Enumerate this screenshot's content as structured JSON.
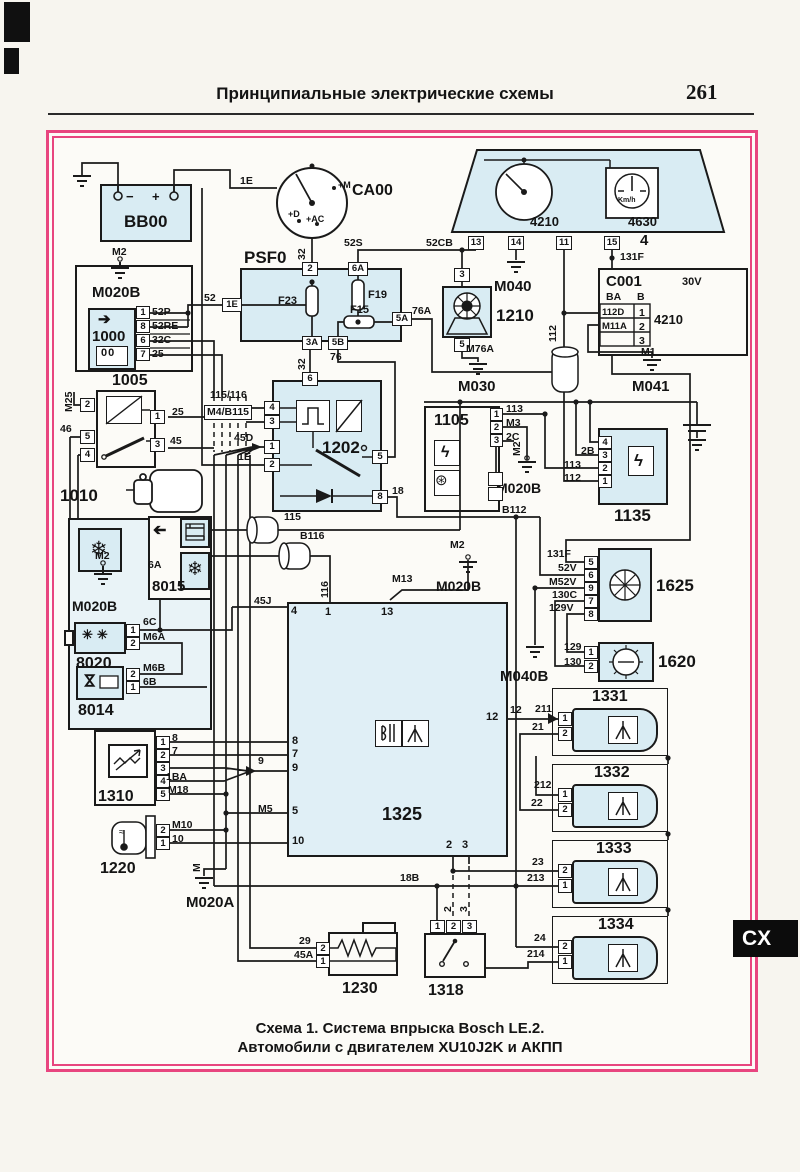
{
  "page": {
    "header": "Принципиальные электрические схемы",
    "page_number": "261",
    "tab": "CX",
    "caption1": "Схема 1. Система впрыска Bosch LE.2.",
    "caption2": "Автомобили с двигателем XU10J2K и АКПП",
    "accent": "#e8457f",
    "fill": "#d9ecf3"
  },
  "components": {
    "bb00": {
      "label": "BB00",
      "minus": "−",
      "plus": "+"
    },
    "ca00": {
      "label": "CA00",
      "tm": "+M",
      "td": "+D",
      "tac": "+AC"
    },
    "psf0": {
      "label": "PSF0",
      "f23": "F23",
      "f19": "F19",
      "f15": "F15",
      "pins": [
        "2",
        "6A",
        "1E",
        "3A",
        "5B",
        "5A"
      ]
    },
    "cluster": {
      "tacho": "4210",
      "speedo": "4630",
      "unit": "Km/h",
      "num": "4",
      "pins": [
        "13",
        "14",
        "11",
        "15"
      ]
    },
    "c001": {
      "label": "C001",
      "volt": "30V",
      "colA": "BA",
      "colB": "B",
      "r1a": "112D",
      "r1b": "1",
      "r2a": "M11A",
      "r2b": "2",
      "r3b": "3",
      "ref": "4210"
    },
    "u1000": {
      "label": "1000",
      "pins": [
        "1",
        "8",
        "6",
        "7"
      ],
      "rows": [
        "52P",
        "52RE",
        "32C",
        "25"
      ]
    },
    "u1005": {
      "label": "1005",
      "pins": [
        "2",
        "5",
        "4",
        "1",
        "3"
      ]
    },
    "u1010": {
      "label": "1010"
    },
    "u1202": {
      "label": "1202",
      "pins": [
        "6",
        "4",
        "3",
        "1",
        "2",
        "5",
        "8"
      ]
    },
    "u1105": {
      "label": "1105",
      "pins": [
        "1",
        "2",
        "3"
      ]
    },
    "u1135": {
      "label": "1135",
      "pins": [
        "4",
        "3",
        "2",
        "1"
      ]
    },
    "u1210": {
      "label": "1210",
      "pins": [
        "3",
        "5"
      ]
    },
    "u1625": {
      "label": "1625",
      "pins": [
        "5",
        "6",
        "9",
        "7",
        "8"
      ]
    },
    "u1620": {
      "label": "1620",
      "pins": [
        "1",
        "2"
      ]
    },
    "u1325": {
      "label": "1325",
      "pins": {
        "p4": "4",
        "p1": "1",
        "p13": "13",
        "p8": "8",
        "p7": "7",
        "p9": "9",
        "p5": "5",
        "p10": "10",
        "p12": "12",
        "p2": "2",
        "p3": "3"
      }
    },
    "u8015": {
      "label": "8015",
      "pin6a": "6A"
    },
    "u8020": {
      "label": "8020",
      "pins": [
        "1",
        "2"
      ]
    },
    "u8014": {
      "label": "8014",
      "pins": [
        "2",
        "1"
      ]
    },
    "u1310": {
      "label": "1310",
      "pins": [
        "1",
        "2",
        "3",
        "4",
        "5"
      ]
    },
    "u1220": {
      "label": "1220",
      "pins": [
        "2",
        "1"
      ]
    },
    "u1230": {
      "label": "1230",
      "pins": [
        "2",
        "1"
      ]
    },
    "u1318": {
      "label": "1318",
      "pins": [
        "1",
        "2",
        "3"
      ]
    },
    "i1331": {
      "label": "1331",
      "pins": [
        "1",
        "2"
      ]
    },
    "i1332": {
      "label": "1332",
      "pins": [
        "1",
        "2"
      ]
    },
    "i1333": {
      "label": "1333",
      "pins": [
        "2",
        "1"
      ]
    },
    "i1334": {
      "label": "1334",
      "pins": [
        "2",
        "1"
      ]
    }
  },
  "wires": {
    "w1e_a": "1E",
    "w32_a": "32",
    "w52s": "52S",
    "w52cb": "52CB",
    "w52": "52",
    "w76a": "76A",
    "w76": "76",
    "w32_b": "32",
    "w25b": "25",
    "w45": "45",
    "wm25": "M25",
    "w46": "46",
    "w115_116": "115/116",
    "wm4_b115": "M4/B115",
    "w45d": "45D",
    "w1e_b": "1E",
    "w18": "18",
    "wb112": "B112",
    "w115": "115",
    "wb116": "B116",
    "w116": "116",
    "wm13": "M13",
    "w45j": "45J",
    "w112": "112",
    "w113a": "113",
    "wm3": "M3",
    "w2c": "2C",
    "w2b": "2B",
    "w113b": "113",
    "w112b": "112",
    "w131fa": "131F",
    "w131fb": "131F",
    "w52v": "52V",
    "wm52v": "M52V",
    "w130c": "130C",
    "w129v": "129V",
    "w129": "129",
    "w130": "130",
    "wm76a": "M76A",
    "wm1": "M1",
    "w12": "12",
    "w211": "211",
    "w21": "21",
    "w212": "212",
    "w22": "22",
    "w23": "23",
    "w213": "213",
    "w24": "24",
    "w214": "214",
    "w8": "8",
    "w7": "7",
    "w9": "9",
    "w1ba": "1BA",
    "wm18": "M18",
    "wm5": "M5",
    "wm10": "M10",
    "w10": "10",
    "w29": "29",
    "w45a": "45A",
    "w18b": "18B",
    "w2v": "2",
    "w3v": "3",
    "w6a": "6A",
    "w6c": "6C",
    "wm6a": "M6A",
    "wm6b": "M6B",
    "w6b": "6B",
    "wm2a": "M2",
    "wm2b": "M2",
    "wm2c": "M2",
    "wm2d": "M2",
    "wm": "M"
  },
  "grounds": {
    "m020b_1": "M020B",
    "m040": "M040",
    "m030": "M030",
    "m041": "M041",
    "m020b_2": "M020B",
    "m020b_3": "M020B",
    "m040b": "M040B",
    "m020a": "M020A",
    "m020b_4": "M020B"
  }
}
